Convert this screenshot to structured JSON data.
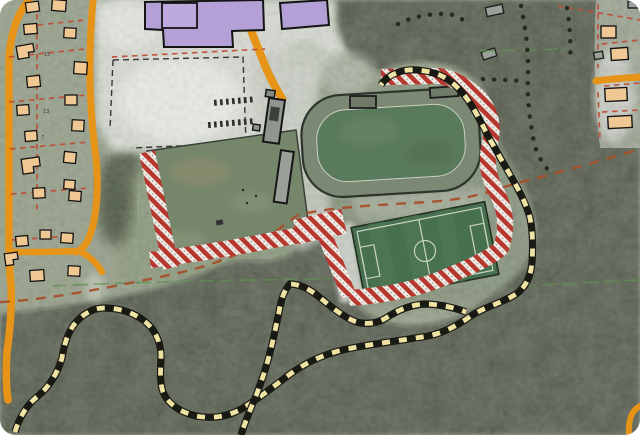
{
  "map": {
    "type": "aerial-planning-map",
    "description": "Aerial orthophoto with municipal planning overlays: school with purple buildings, parking, practice field, athletics track, soccer pitch, red hatched restriction bands around the sports grounds, yellow-black marked hiking trails and dotted forest paths, orange roads, residential parcels with red dashed lot lines",
    "plot_numbers": {
      "a": "15",
      "b": "13",
      "c": "7"
    },
    "colors": {
      "forest": "#3f4a35",
      "residential_ground": "#96a089",
      "school_grounds": "#d6dad1",
      "practice_field": "#76866b",
      "track_ring": "#7b8873",
      "track_infield": "#5a7a5c",
      "soccer_pitch": "#47704e",
      "road_orange": "#e69417",
      "school_purple": "#b3a0d6",
      "house_beige": "#f0c893",
      "hatch_red": "#b8352c",
      "hatch_bg": "#f2efe9",
      "trail_yellow": "#efe3a4",
      "trail_black": "#1a1a14",
      "boundary_brown": "#a8502b",
      "boundary_green": "#5e9150",
      "parcel_dash_red": "#bf4a33"
    },
    "features": {
      "sports": [
        "practice-field",
        "athletics-track-field",
        "soccer-pitch"
      ],
      "buildings": {
        "purple_school": 2,
        "houses_west": 22,
        "houses_east": 5,
        "gray_sheds": 3,
        "clubhouse_units": 4
      },
      "overlays": [
        "red-hatched-restriction-band",
        "yellow-black-marked-trail",
        "black-dotted-forest-trail",
        "brown-dashed-boundary-line",
        "green-dashed-boundary-line",
        "red-dashed-parcel-lines"
      ]
    }
  }
}
